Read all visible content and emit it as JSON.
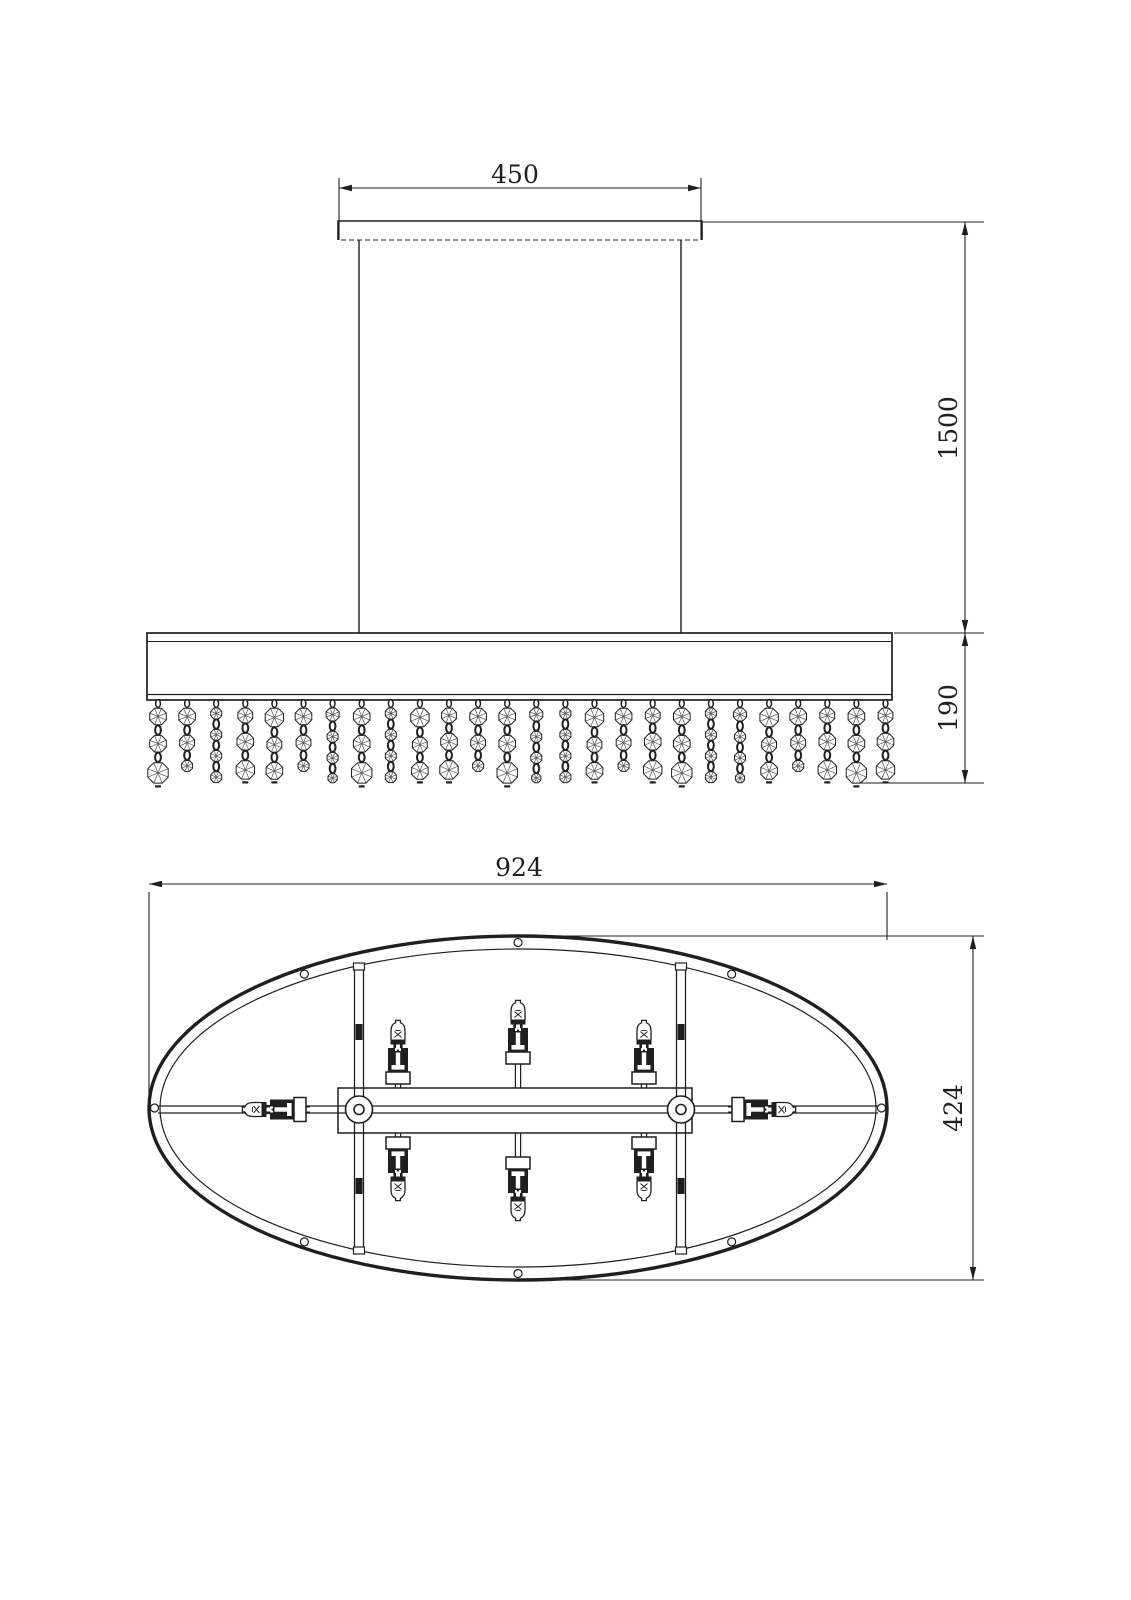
{
  "drawing_title": "oval-crystal-chandelier-dimension-drawing",
  "colors": {
    "background": "#ffffff",
    "line": "#1f1f1f",
    "crystal_line": "#555555"
  },
  "dimensions": {
    "canopy_width": "450",
    "suspension_height": "1500",
    "body_height": "190",
    "fixture_length": "924",
    "fixture_width": "424"
  },
  "figures": {
    "side_view": {
      "crystal_strands": 26,
      "suspension_rods": 2
    },
    "plan_view": {
      "lamp_holders": 8,
      "rim_screw_holes": 8,
      "suspension_hubs": 2
    }
  },
  "geometry": {
    "side": {
      "canopy": {
        "x1": 338,
        "x2": 702,
        "y_top": 221,
        "y_bottom": 240
      },
      "rod_xs": [
        359,
        681
      ],
      "rod_y1": 240,
      "rod_y2": 633,
      "shade": {
        "x": 147,
        "y": 633,
        "w": 745,
        "h": 67,
        "line_top": 641.5,
        "line_bottom": 694.5
      },
      "strands": {
        "x0": 158,
        "dx": 29.1,
        "count": 26,
        "hook_y": 703.5,
        "start_y": 707.5,
        "patterns": [
          [
            9,
            9,
            11
          ],
          [
            9,
            8,
            6
          ],
          [
            6,
            6,
            6,
            6
          ],
          [
            8,
            9,
            10
          ],
          [
            7,
            6,
            6,
            5
          ],
          [
            10,
            8,
            9
          ]
        ],
        "sequence": [
          0,
          1,
          2,
          3,
          5,
          1,
          4,
          0,
          2,
          5,
          3,
          1,
          0,
          4,
          2,
          5,
          1,
          3,
          0,
          2,
          4,
          5,
          1,
          3,
          0,
          3
        ]
      },
      "dim_top": {
        "y": 188,
        "x1": 339,
        "x2": 701,
        "ext_y_top": 178,
        "ext_y_bottom": 240
      },
      "dim_right": {
        "x": 965,
        "y_top": 222,
        "y_mid": 633,
        "y_bottom": 783,
        "ext_lines": [
          [
            703,
            984,
            222
          ],
          [
            894,
            984,
            633
          ],
          [
            855,
            984,
            783
          ]
        ]
      }
    },
    "plan": {
      "cx": 518,
      "cy": 1108,
      "outer_rx": 369,
      "outer_ry": 172,
      "inner_rx": 358,
      "inner_ry": 159,
      "hole_radius": 4,
      "hole_angles_deg": [
        0,
        54,
        90,
        126,
        180,
        234,
        270,
        306
      ],
      "rod": {
        "x1": 158,
        "x2": 878,
        "y_top": 1106,
        "y_bottom": 1113
      },
      "struts": {
        "xs": [
          359,
          681
        ],
        "y1": 964,
        "y2": 1254,
        "half_gap": 4.5,
        "cap_ys": [
          963,
          1247
        ],
        "block_ys": [
          1024,
          1178
        ]
      },
      "frame": {
        "x": 338,
        "y": 1088,
        "w": 354,
        "h": 45
      },
      "hubs": {
        "xs": [
          359,
          681
        ],
        "cy": 1109.5,
        "r_outer": 13.5,
        "r_inner": 5
      },
      "lamps": [
        {
          "x": 398,
          "y": 1088,
          "dir": "up",
          "stem": 4
        },
        {
          "x": 518,
          "y": 1088,
          "dir": "up",
          "stem": 24
        },
        {
          "x": 644,
          "y": 1088,
          "dir": "up",
          "stem": 4
        },
        {
          "x": 398,
          "y": 1133,
          "dir": "down",
          "stem": 4
        },
        {
          "x": 518,
          "y": 1133,
          "dir": "down",
          "stem": 24
        },
        {
          "x": 644,
          "y": 1133,
          "dir": "down",
          "stem": 4
        },
        {
          "x": 310,
          "y": 1109.5,
          "dir": "left",
          "stem": 4
        },
        {
          "x": 728,
          "y": 1109.5,
          "dir": "right",
          "stem": 4
        }
      ],
      "dim_top": {
        "y": 884,
        "x1": 149,
        "x2": 887,
        "ext": [
          [
            149,
            892,
            1098
          ],
          [
            887,
            892,
            940
          ]
        ]
      },
      "dim_right": {
        "x": 973,
        "y1": 936,
        "y2": 1280,
        "ext_x1": 518,
        "ext_x2": 984
      }
    }
  }
}
